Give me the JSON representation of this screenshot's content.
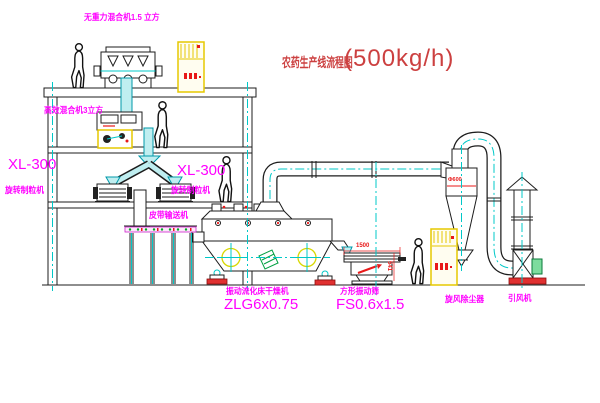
{
  "title": {
    "name_cn": "农药生产线流程图",
    "capacity": "(500kg/h)"
  },
  "equipment_labels": {
    "top_mixer": "无重力混合机1.5 立方",
    "floor2_mixer": "高效混合机3立方",
    "granulator_left_model": "XL-300",
    "granulator_left_name": "旋转制粒机",
    "granulator_right_model": "XL-300",
    "granulator_right_name": "旋转制粒机",
    "belt_conveyor": "皮带输送机",
    "dryer_name": "振动流化床干燥机",
    "dryer_model": "ZLG6x0.75",
    "screen_name": "方形振动筛",
    "screen_model": "FS0.6x1.5",
    "cyclone_name": "旋风除尘器",
    "fan_name": "引风机"
  },
  "dimensions": {
    "screen_length": "1500",
    "screen_height": "541",
    "cyclone_note": "Φ600"
  },
  "colors": {
    "label_magenta": "#ff00ff",
    "title_red": "#cc4040",
    "dim_red": "#e81919",
    "cabinet_yellow": "#e6c800",
    "centerline_cyan": "#00c8c8",
    "line_dark": "#1c1c1c",
    "machine_green": "#00a040"
  }
}
